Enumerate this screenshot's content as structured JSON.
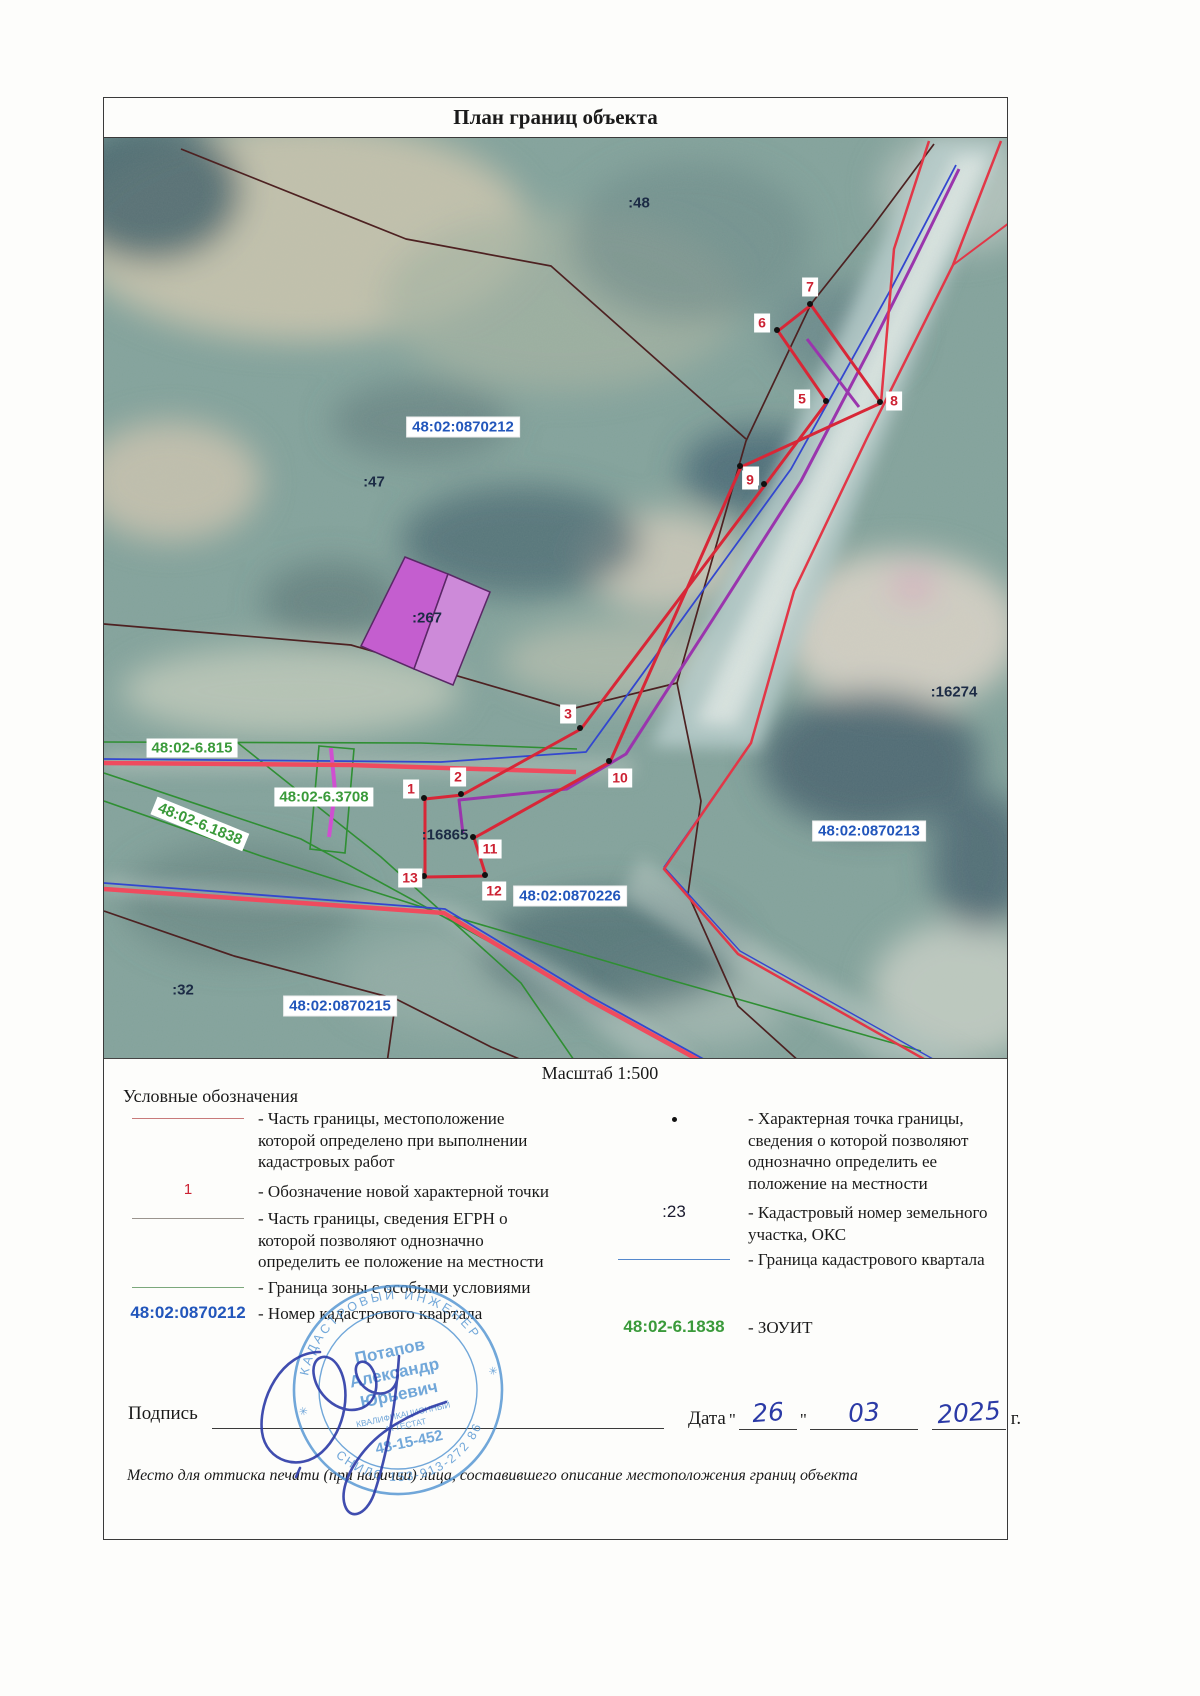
{
  "title": "План границ объекта",
  "scale_text": "Масштаб 1:500",
  "map": {
    "area_labels": [
      {
        "text": ":48",
        "x": 639,
        "y": 203,
        "style": "plain"
      },
      {
        "text": "48:02:0870212",
        "x": 463,
        "y": 427,
        "style": "blue"
      },
      {
        "text": ":47",
        "x": 374,
        "y": 482,
        "style": "plain"
      },
      {
        "text": ":267",
        "x": 427,
        "y": 618,
        "style": "plain"
      },
      {
        "text": ":16274",
        "x": 954,
        "y": 692,
        "style": "plain"
      },
      {
        "text": "48:02-6.815",
        "x": 192,
        "y": 748,
        "style": "green"
      },
      {
        "text": "48:02-6.3708",
        "x": 324,
        "y": 797,
        "style": "green"
      },
      {
        "text": "48:02-6.1838",
        "x": 200,
        "y": 824,
        "style": "green",
        "rotate": 22
      },
      {
        "text": ":16865",
        "x": 445,
        "y": 835,
        "style": "plain"
      },
      {
        "text": "48:02:0870226",
        "x": 570,
        "y": 896,
        "style": "blue"
      },
      {
        "text": "48:02:0870213",
        "x": 869,
        "y": 831,
        "style": "blue"
      },
      {
        "text": ":32",
        "x": 183,
        "y": 990,
        "style": "plain"
      },
      {
        "text": "48:02:0870215",
        "x": 340,
        "y": 1006,
        "style": "blue"
      }
    ],
    "points": [
      {
        "n": "1",
        "dx": 424,
        "dy": 798,
        "lx": 411,
        "ly": 789
      },
      {
        "n": "2",
        "dx": 461,
        "dy": 794,
        "lx": 458,
        "ly": 777
      },
      {
        "n": "3",
        "dx": 580,
        "dy": 728,
        "lx": 568,
        "ly": 714
      },
      {
        "n": "4",
        "dx": 764,
        "dy": 484,
        "lx": 751,
        "ly": 476
      },
      {
        "n": "5",
        "dx": 826,
        "dy": 401,
        "lx": 802,
        "ly": 399
      },
      {
        "n": "6",
        "dx": 777,
        "dy": 330,
        "lx": 762,
        "ly": 323
      },
      {
        "n": "7",
        "dx": 810,
        "dy": 304,
        "lx": 810,
        "ly": 287
      },
      {
        "n": "8",
        "dx": 880,
        "dy": 402,
        "lx": 894,
        "ly": 401
      },
      {
        "n": "9",
        "dx": 740,
        "dy": 466,
        "lx": 750,
        "ly": 480
      },
      {
        "n": "10",
        "dx": 609,
        "dy": 761,
        "lx": 620,
        "ly": 778
      },
      {
        "n": "11",
        "dx": 473,
        "dy": 837,
        "lx": 490,
        "ly": 849
      },
      {
        "n": "12",
        "dx": 485,
        "dy": 875,
        "lx": 494,
        "ly": 891
      },
      {
        "n": "13",
        "dx": 424,
        "dy": 876,
        "lx": 410,
        "ly": 878
      }
    ]
  },
  "legend": {
    "heading": "Условные обозначения",
    "left": [
      {
        "symbol": "red-line",
        "symbol_text": "",
        "text": "- Часть границы, местоположение которой определено при выполнении кадастровых работ"
      },
      {
        "symbol": "red-num",
        "symbol_text": "1",
        "text": "- Обозначение новой характерной точки",
        "gap": 8
      },
      {
        "symbol": "gray-line",
        "symbol_text": "",
        "text": "- Часть границы, сведения ЕГРН о которой позволяют однозначно определить ее положение на местности",
        "gap": 6
      },
      {
        "symbol": "green-line",
        "symbol_text": "",
        "text": "- Граница зоны с особыми условиями",
        "gap": 4
      },
      {
        "symbol": "blue-num",
        "symbol_text": "48:02:0870212",
        "text": "- Номер кадастрового квартала",
        "gap": 5
      }
    ],
    "right": [
      {
        "symbol": "dot",
        "symbol_text": "",
        "text": "- Характерная точка границы, сведения о которой позволяют однозначно определить ее положение на местности"
      },
      {
        "symbol": "black-num",
        "symbol_text": ":23",
        "text": "- Кадастровый номер земельного участка, ОКС",
        "gap": 8
      },
      {
        "symbol": "blue-line",
        "symbol_text": "",
        "text": "- Граница кадастрового квартала",
        "gap": 4
      },
      {
        "symbol": "green-num",
        "symbol_text": "48:02-6.1838",
        "text": "- ЗОУИТ",
        "gap": 46
      }
    ]
  },
  "footer": {
    "signature_label": "Подпись",
    "date_label": "Дата",
    "quote": "\"",
    "date_day": "26",
    "date_month": "03",
    "date_year": "2025",
    "date_suffix": "г.",
    "note": "Место для оттиска печати (при наличии) лица, составившего описание местоположения границ объекта"
  },
  "stamp": {
    "ring_top": "КАДАСТРОВЫЙ ИНЖЕНЕР",
    "ring_bottom": "СНИЛС 153-913-272 86",
    "star_left": "✳",
    "star_right": "✳",
    "name_line1": "Потапов",
    "name_line2": "Александр",
    "name_line3": "Юрьевич",
    "cert_line1": "КВАЛИФИКАЦИОННЫЙ",
    "cert_line2": "АТТЕСТАТ",
    "cert_number": "48-15-452"
  },
  "colors": {
    "label_blue": "#2256bb",
    "label_green": "#3a9a3a",
    "point_red": "#cc2233",
    "navy": "#1c2b45",
    "stamp_blue": "#4a8fd0",
    "ink_blue": "#2b3aa6",
    "boundary_red": "#d82737",
    "road_red": "#ef4b5e",
    "egrn_dark": "#4d2121",
    "quarter_blue": "#3347cf",
    "zouit_green": "#2f8f33",
    "purple": "#9a35ad"
  }
}
